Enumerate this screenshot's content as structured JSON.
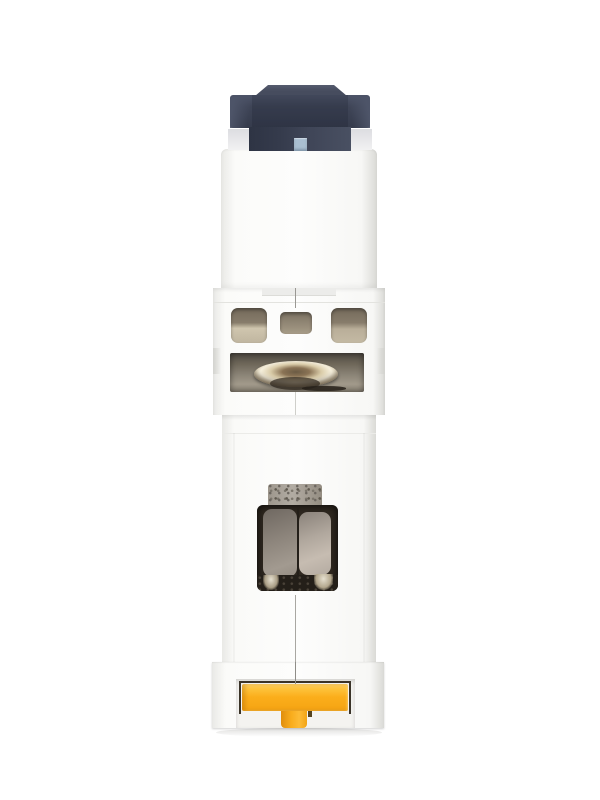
{
  "scene": {
    "subject": "white DIN-rail miniature circuit breaker photographed end-on (top view)",
    "background_color": "#ffffff",
    "visible_text": "",
    "parts": [
      "dark slate toggle actuator with raised cap and small blue indicator window",
      "white plastic housing in stacked molded sections",
      "three beige ventilation/terminal openings",
      "recessed metallic terminal screw head",
      "speckled metal contact tab above a dark contact window with two taupe lobes",
      "yellow T-shaped DIN-rail release clip at bottom"
    ]
  },
  "colors": {
    "bg": "#ffffff",
    "toggle_dark": "#353b4c",
    "toggle_mid": "#3f4557",
    "toggle_light": "#4d5468",
    "toggle_cap": "#464c5e",
    "toggle_cap_edge": "#555b6e",
    "indicator_blue": "#a9bed1",
    "shoulder_gray": "#dcdde1",
    "body_white": "#fdfdfc",
    "body_soft": "#f7f7f5",
    "body_shade": "#e9e9e6",
    "body_edge": "#dadad6",
    "seam_dark": "#9a9893",
    "seam_light": "#cfcfca",
    "ledge_line": "#e3e3df",
    "opening_top": "#746a5b",
    "opening_mid": "#877c6b",
    "opening_light": "#cfc5ae",
    "opening_center_mid": "#9a8f7c",
    "recess_top": "#4f4a42",
    "recess_mid": "#8a8376",
    "recess_light": "#a29a8b",
    "screw_bright": "#f7f1de",
    "screw_gold": "#d9cba8",
    "screw_bronze": "#8a7355",
    "screw_dark": "#51463a",
    "tab_metal": "#9d968c",
    "tab_metal_light": "#b2aca3",
    "tab_speckle": "#6d6760",
    "window_frame": "#2f2820",
    "window_dark": "#241f19",
    "lobe_left_1": "#6f6861",
    "lobe_left_2": "#a29a90",
    "lobe_right_1": "#8a827a",
    "lobe_right_2": "#c6bcb1",
    "glint": "#e6e0d0",
    "clip_outline": "#3a3328",
    "clip_yellow": "#fbae1b",
    "clip_yellow_light": "#ffd469",
    "clip_yellow_deep": "#f5a413",
    "clip_orange_dark": "#e08d0c",
    "ground_shadow": "rgba(80,78,70,0.18)"
  }
}
